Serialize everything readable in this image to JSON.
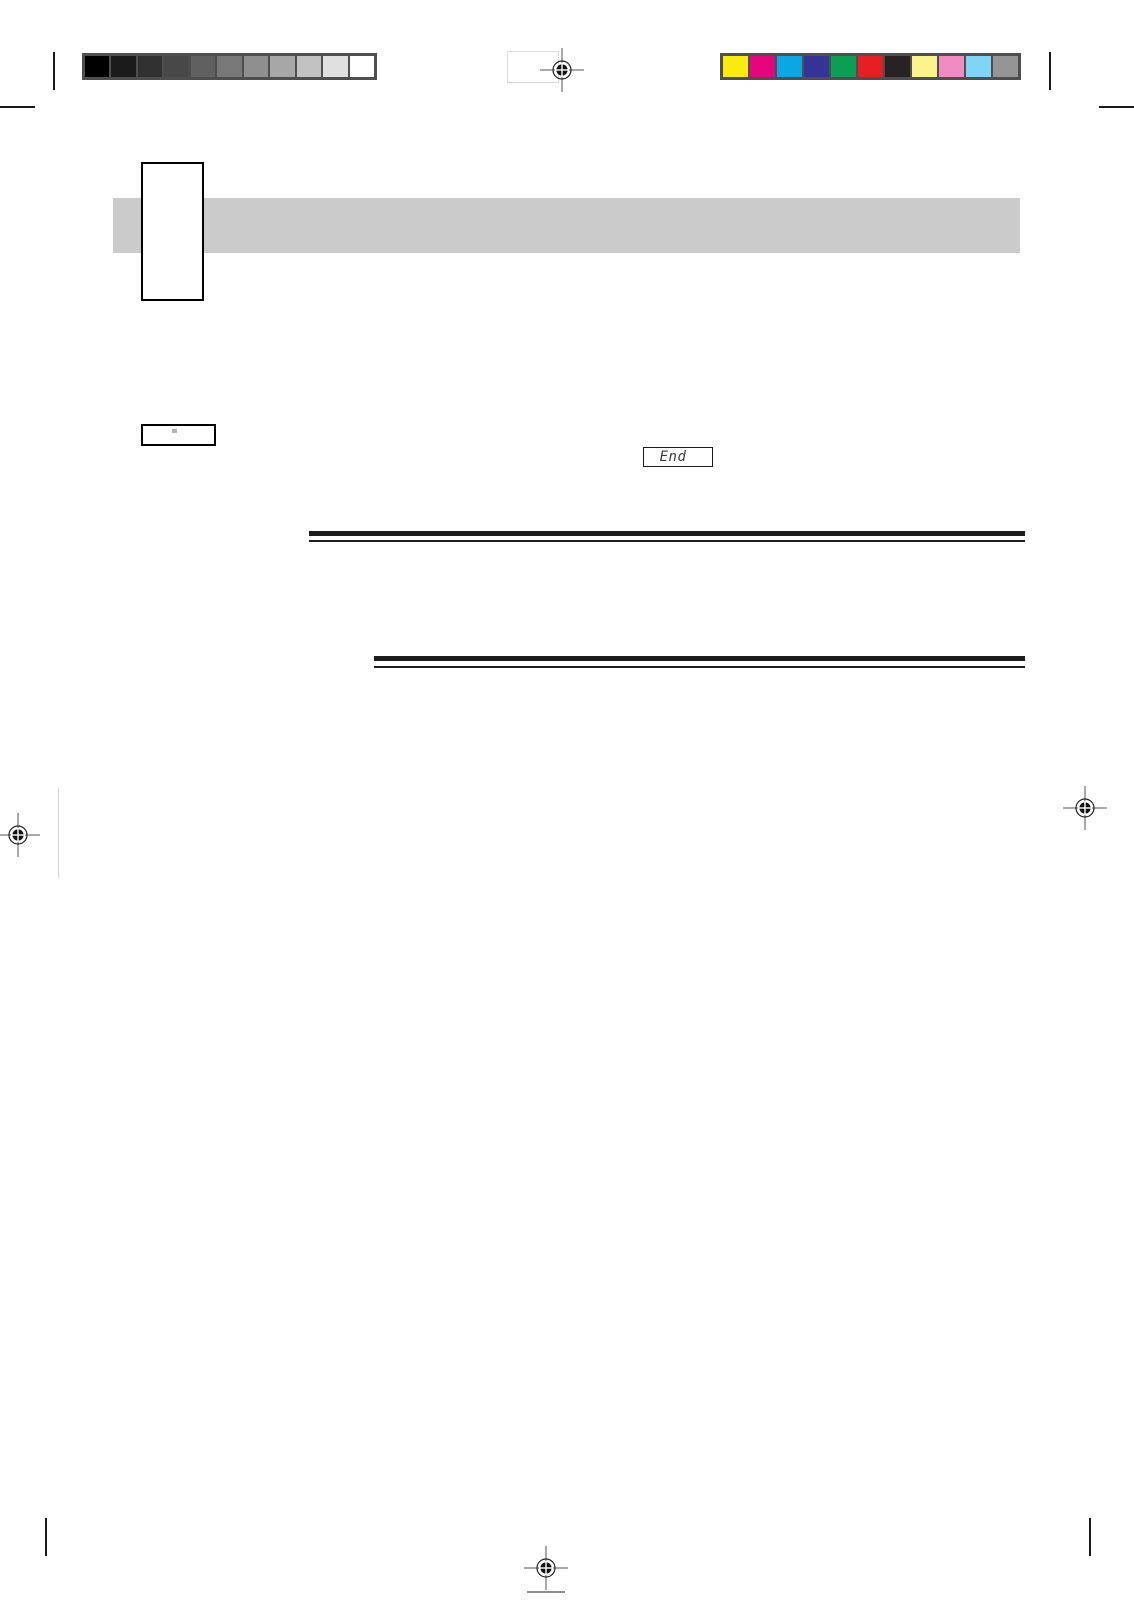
{
  "calibration": {
    "frame_color": "#4e4e4e",
    "grayscale_swatches": [
      "#000000",
      "#1b1b1b",
      "#313131",
      "#484848",
      "#606060",
      "#787878",
      "#8f8f8f",
      "#a7a7a7",
      "#c2c2c2",
      "#e0e0e0",
      "#ffffff"
    ],
    "color_swatches": [
      "#f8ec0e",
      "#e5067e",
      "#0aa7e2",
      "#343397",
      "#09a053",
      "#e81e25",
      "#282223",
      "#fbf48c",
      "#f18cc3",
      "#7ed5f6",
      "#959595"
    ]
  },
  "header": {
    "bar_color": "#cbcbcb"
  },
  "display": {
    "end_label": "End"
  },
  "marks": {
    "registration_ink": "#111111"
  }
}
